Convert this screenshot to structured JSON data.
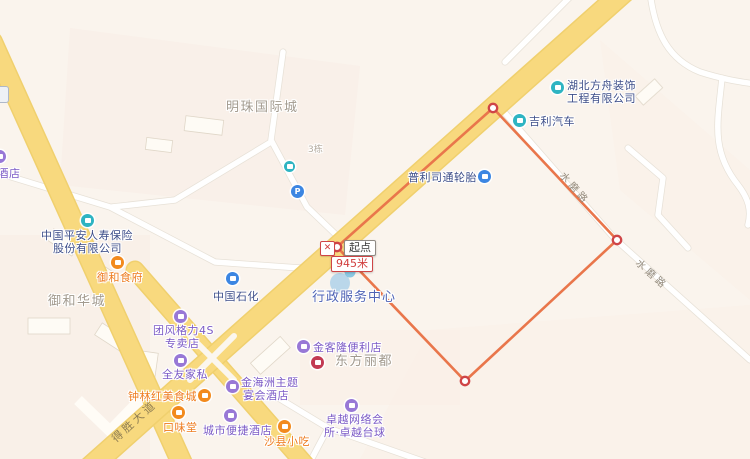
{
  "map": {
    "measure_tool": {
      "start_label": "起点",
      "distance_label": "945米",
      "close_glyph": "✕",
      "line_color": "#e9764b",
      "vertex_ring_color": "#cf4547"
    },
    "road_labels": {
      "desheng_avenue": "得胜大道",
      "shuimo_road_upper": "水磨路",
      "shuimo_road_lower": "水磨路"
    },
    "area_labels": {
      "mingzhu": "明珠国际城",
      "yuhe_huacheng": "御和华城",
      "building_3": "3栋"
    },
    "pois": {
      "hubei_fangzhou": {
        "line1": "湖北方舟装饰",
        "line2": "工程有限公司"
      },
      "jili_auto": {
        "text": "吉利汽车"
      },
      "bridgestone": {
        "text": "普利司通轮胎"
      },
      "pingan": {
        "line1": "中国平安人寿保险",
        "line2": "股份有限公司"
      },
      "yuhe_shifu": {
        "text": "御和食府"
      },
      "sinopec": {
        "text": "中国石化"
      },
      "admin_center": {
        "text": "行政服务中心"
      },
      "geli_4s": {
        "line1": "团风格力4S",
        "line2": "专卖店"
      },
      "quanyou": {
        "text": "全友家私"
      },
      "zhonglin": {
        "text": "钟林红美食城"
      },
      "kouweitang": {
        "text": "口味堂"
      },
      "jinhaizhou": {
        "line1": "金海洲主题",
        "line2": "宴会酒店"
      },
      "city_comfort": {
        "text": "城市便捷酒店"
      },
      "shaxian": {
        "text": "沙县小吃"
      },
      "jinkelong": {
        "text": "金客隆便利店"
      },
      "dongfang_lidu": {
        "text": "东方丽都"
      },
      "zhuoyue": {
        "line1": "卓越网络会",
        "line2": "所·卓越台球"
      },
      "hotel_partial": {
        "text": "大酒店"
      },
      "parking": {
        "glyph": "P"
      }
    },
    "colors": {
      "background": "#faf4ed",
      "major_road_yellow": "#f7d77b",
      "minor_road_white": "#ffffff",
      "measure_orange": "#e9764b",
      "vertex_red": "#cf4547",
      "poi_navy": "#3d4e89",
      "poi_purple": "#7b5ac6",
      "poi_orange": "#ee7b1e",
      "icon_teal": "#2eb4c2",
      "icon_blue": "#3c86e2",
      "icon_red": "#c23a52",
      "area_gray": "#a29a8e"
    }
  }
}
